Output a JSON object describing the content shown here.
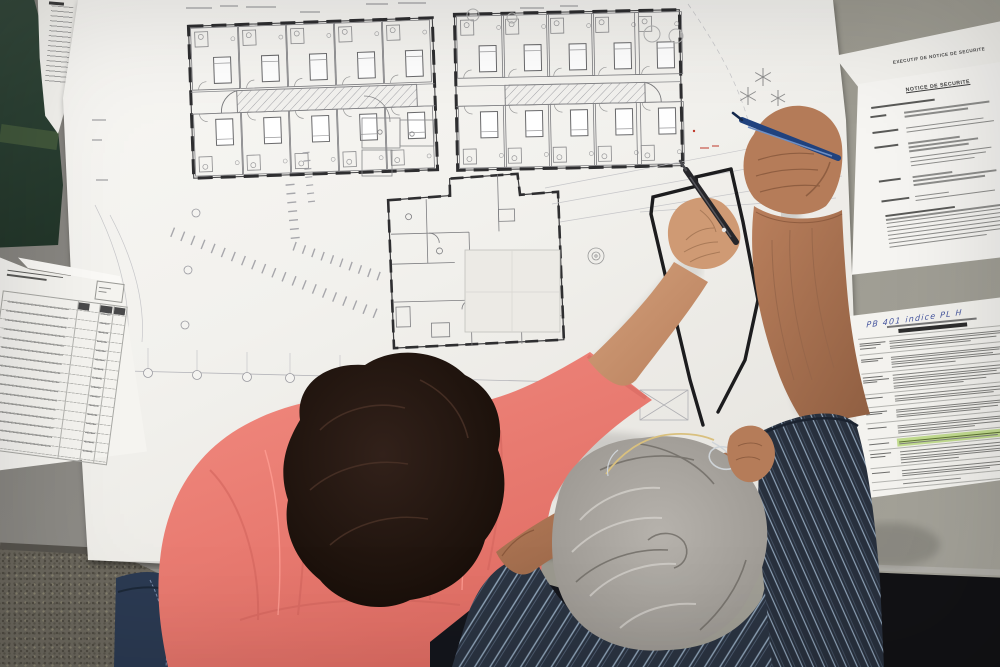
{
  "scene": {
    "type": "photograph-overhead",
    "description": "Two architects leaning over a drafting table covered by a large architectural floor plan; a woman in a coral shirt sketches with a black pen while a gray-haired man in a striped navy shirt holds a blue pen",
    "woman": "dark-haired woman, coral shirt, black pen",
    "man": "gray-haired man, navy striped shirt, glasses on head, blue pen"
  },
  "plan_sheet": {
    "kind": "architectural floor plan",
    "features": "room wings with corridors, service block, parking hatching, tree symbols, hand-sketched extension outline"
  },
  "documents": {
    "back_sheet_title": "EXECUTIF DE NOTICE DE SECURITE",
    "front_sheet_title": "NOTICE DE SECURITE",
    "annex_handwritten_note": "PB 401 indice PL H",
    "left_sheet_kind": "project index table"
  },
  "colors": {
    "table": "#8f8d88",
    "paper": "#f4f3f0",
    "coral_shirt": "#ef8177",
    "navy_shirt": "#2b3442",
    "green_folder": "#2b4033",
    "blue_pen": "#20427e",
    "black_pen": "#26262a",
    "highlight_row": "#c3dd90"
  }
}
